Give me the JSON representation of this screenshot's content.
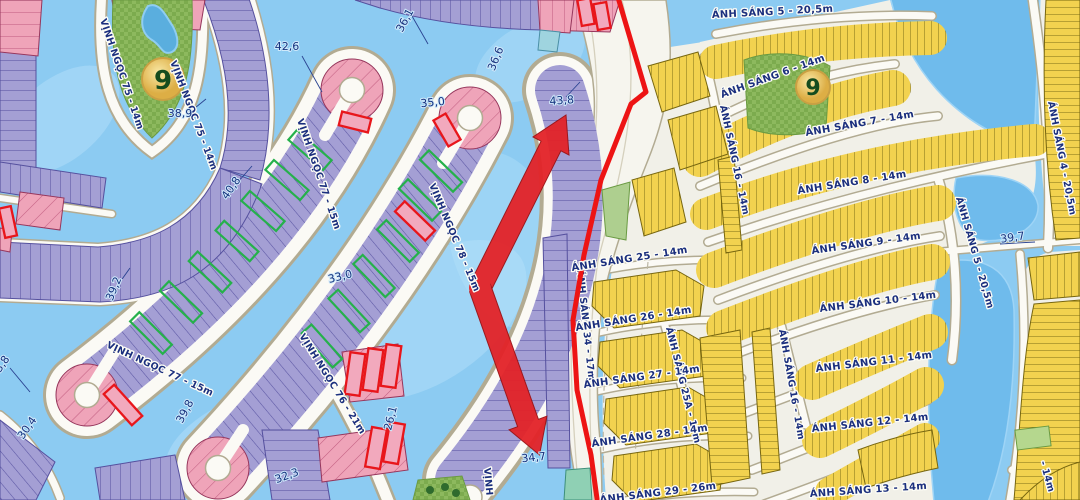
{
  "streets": {
    "s5t": "ÁNH SÁNG 5 - 20,5m",
    "s6": "ÁNH SÁNG 6 - 14m",
    "s7": "ÁNH SÁNG 7 - 14m",
    "s8": "ÁNH SÁNG 8 - 14m",
    "s9": "ÁNH SÁNG 9 - 14m",
    "s10": "ÁNH SÁNG 10 - 14m",
    "s11": "ÁNH SÁNG 11 - 14m",
    "s12": "ÁNH SÁNG 12 - 14m",
    "s13": "ÁNH SÁNG 13 - 14m",
    "s16n": "ÁNH SÁNG 16 - 14m",
    "s16s": "ÁNH SÁNG 16 - 14m",
    "s25": "ÁNH SÁNG 25 - 14m",
    "s25a": "ÁNH SÁNG 25A - 17m",
    "s26": "ÁNH SÁNG 26 - 14m",
    "s27": "ÁNH SÁNG 27 - 14m",
    "s28": "ÁNH SÁNG 28 - 14m",
    "s29": "ÁNH SÁNG 29 - 26m",
    "s34": "ÁNH SÁNG 34 - 17m",
    "s4": "ÁNH SÁNG 4 - 20,5m",
    "s5v": "ÁNH SÁNG 5 - 20,5m",
    "s_frag_14m": "- 14m",
    "vn75w": "VỊNH NGỌC 75 - 14m",
    "vn75e": "VỊNH NGỌC 75 - 14m",
    "vn77n": "VỊNH NGỌC 77 - 15m",
    "vn77s": "VỊNH NGỌC 77 - 15m",
    "vn78": "VỊNH NGỌC 78 - 15m",
    "vn76": "VỊNH NGỌC 76 - 21m",
    "vn_frag": "VỊNH"
  },
  "dims": {
    "d38_9": "38,9",
    "d42_6": "42,6",
    "d36_1": "36,1",
    "d36_6": "36,6",
    "d35_0": "35,0",
    "d43_8": "43,8",
    "d40_8": "40,8",
    "d33_0": "33,0",
    "d39_2": "39,2",
    "d39_8": "39,8",
    "d30_4": "30,4",
    "d32_3": "32,3",
    "d26_1": "26,1",
    "d34_7": "34,7",
    "d39_7": "39,7",
    "d3_8": "3,8"
  },
  "markers": {
    "hole_left": "9",
    "hole_right": "9"
  },
  "colors": {
    "water": "#8ccbf2",
    "water_deep": "#6fbbec",
    "parcel_purple": "#a49fd4",
    "parcel_pink": "#efa4b9",
    "parcel_yellow": "#f2d24f",
    "park_green": "#8db95e",
    "road": "#fbfaf5",
    "boundary_red": "#ed1414",
    "arrow_red": "#e32328",
    "available_green": "#25b14b",
    "sold_red": "#e8161b",
    "label_blue": "#1b2f7e",
    "badge_gold": "#e9c05a"
  }
}
